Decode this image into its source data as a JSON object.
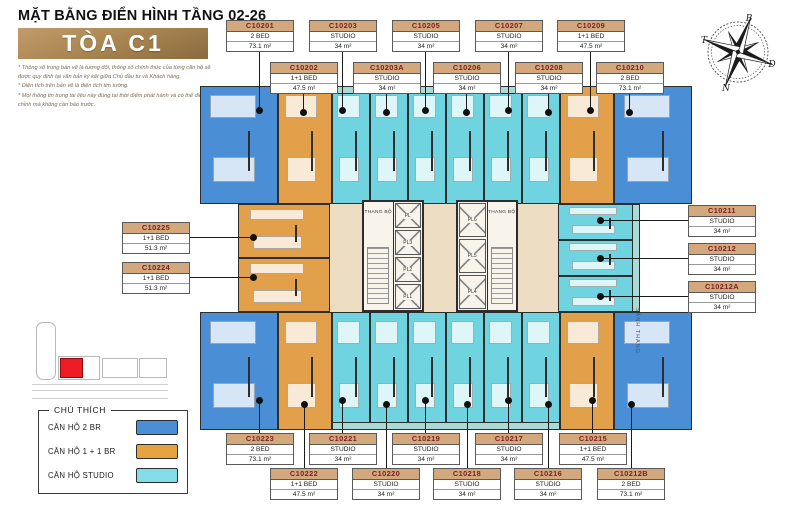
{
  "header": {
    "title": "MẶT BẰNG ĐIỂN HÌNH TẦNG 02-26",
    "tower": "TÒA C1",
    "notes": [
      "* Thông số trong bản vẽ là tương đối, thông số chính thức của từng căn hộ sẽ được quy định tại văn bản ký kết giữa Chủ đầu tư và Khách hàng.",
      "* Diện tích trên bản vẽ là diện tích tim tường.",
      "* Mọi thông tin trong tài liệu này đúng tại thời điểm phát hành và có thể điều chỉnh mà không cần báo trước."
    ]
  },
  "compass": {
    "north": "B",
    "east": "Đ",
    "south": "N",
    "west": "T"
  },
  "legend": {
    "title": "CHÚ THÍCH",
    "items": [
      {
        "label": "CĂN HỘ 2 BR",
        "color": "#4a8ed5"
      },
      {
        "label": "CĂN HỘ 1 + 1 BR",
        "color": "#e5a440"
      },
      {
        "label": "CĂN HỘ STUDIO",
        "color": "#83dde8"
      }
    ]
  },
  "core": {
    "stair_left": "THANG BỘ",
    "stair_right": "THANG BỘ",
    "lobby": "SẢNH THANG",
    "lifts_left": [
      "PL",
      "PL3",
      "PL2",
      "PL1"
    ],
    "lifts_right": [
      "PL6",
      "PL5",
      "PL4"
    ]
  },
  "plan": {
    "colors": {
      "two_br": "#4a8ed5",
      "one_one": "#e2a04b",
      "studio": "#6fd4e0"
    },
    "units": [
      {
        "id": "C10201",
        "type": "2 BED",
        "area": "73.1 m²",
        "cat": "two_br"
      },
      {
        "id": "C10202",
        "type": "1+1 BED",
        "area": "47.5 m²",
        "cat": "one_one"
      },
      {
        "id": "C10203",
        "type": "STUDIO",
        "area": "34 m²",
        "cat": "studio"
      },
      {
        "id": "C10203A",
        "type": "STUDIO",
        "area": "34 m²",
        "cat": "studio"
      },
      {
        "id": "C10205",
        "type": "STUDIO",
        "area": "34 m²",
        "cat": "studio"
      },
      {
        "id": "C10206",
        "type": "STUDIO",
        "area": "34 m²",
        "cat": "studio"
      },
      {
        "id": "C10207",
        "type": "STUDIO",
        "area": "34 m²",
        "cat": "studio"
      },
      {
        "id": "C10208",
        "type": "STUDIO",
        "area": "34 m²",
        "cat": "studio"
      },
      {
        "id": "C10209",
        "type": "1+1 BED",
        "area": "47.5 m²",
        "cat": "one_one"
      },
      {
        "id": "C10210",
        "type": "2 BED",
        "area": "73.1 m²",
        "cat": "two_br"
      },
      {
        "id": "C10211",
        "type": "STUDIO",
        "area": "34 m²",
        "cat": "studio"
      },
      {
        "id": "C10212",
        "type": "STUDIO",
        "area": "34 m²",
        "cat": "studio"
      },
      {
        "id": "C10212A",
        "type": "STUDIO",
        "area": "34 m²",
        "cat": "studio"
      },
      {
        "id": "C10212B",
        "type": "2 BED",
        "area": "73.1 m²",
        "cat": "two_br"
      },
      {
        "id": "C10215",
        "type": "1+1 BED",
        "area": "47.5 m²",
        "cat": "one_one"
      },
      {
        "id": "C10216",
        "type": "STUDIO",
        "area": "34 m²",
        "cat": "studio"
      },
      {
        "id": "C10217",
        "type": "STUDIO",
        "area": "34 m²",
        "cat": "studio"
      },
      {
        "id": "C10218",
        "type": "STUDIO",
        "area": "34 m²",
        "cat": "studio"
      },
      {
        "id": "C10219",
        "type": "STUDIO",
        "area": "34 m²",
        "cat": "studio"
      },
      {
        "id": "C10220",
        "type": "STUDIO",
        "area": "34 m²",
        "cat": "studio"
      },
      {
        "id": "C10221",
        "type": "STUDIO",
        "area": "34 m²",
        "cat": "studio"
      },
      {
        "id": "C10222",
        "type": "1+1 BED",
        "area": "47.5 m²",
        "cat": "one_one"
      },
      {
        "id": "C10223",
        "type": "2 BED",
        "area": "73.1 m²",
        "cat": "two_br"
      },
      {
        "id": "C10224",
        "type": "1+1 BED",
        "area": "51.3 m²",
        "cat": "one_one"
      },
      {
        "id": "C10225",
        "type": "1+1 BED",
        "area": "51.3 m²",
        "cat": "one_one"
      }
    ]
  }
}
